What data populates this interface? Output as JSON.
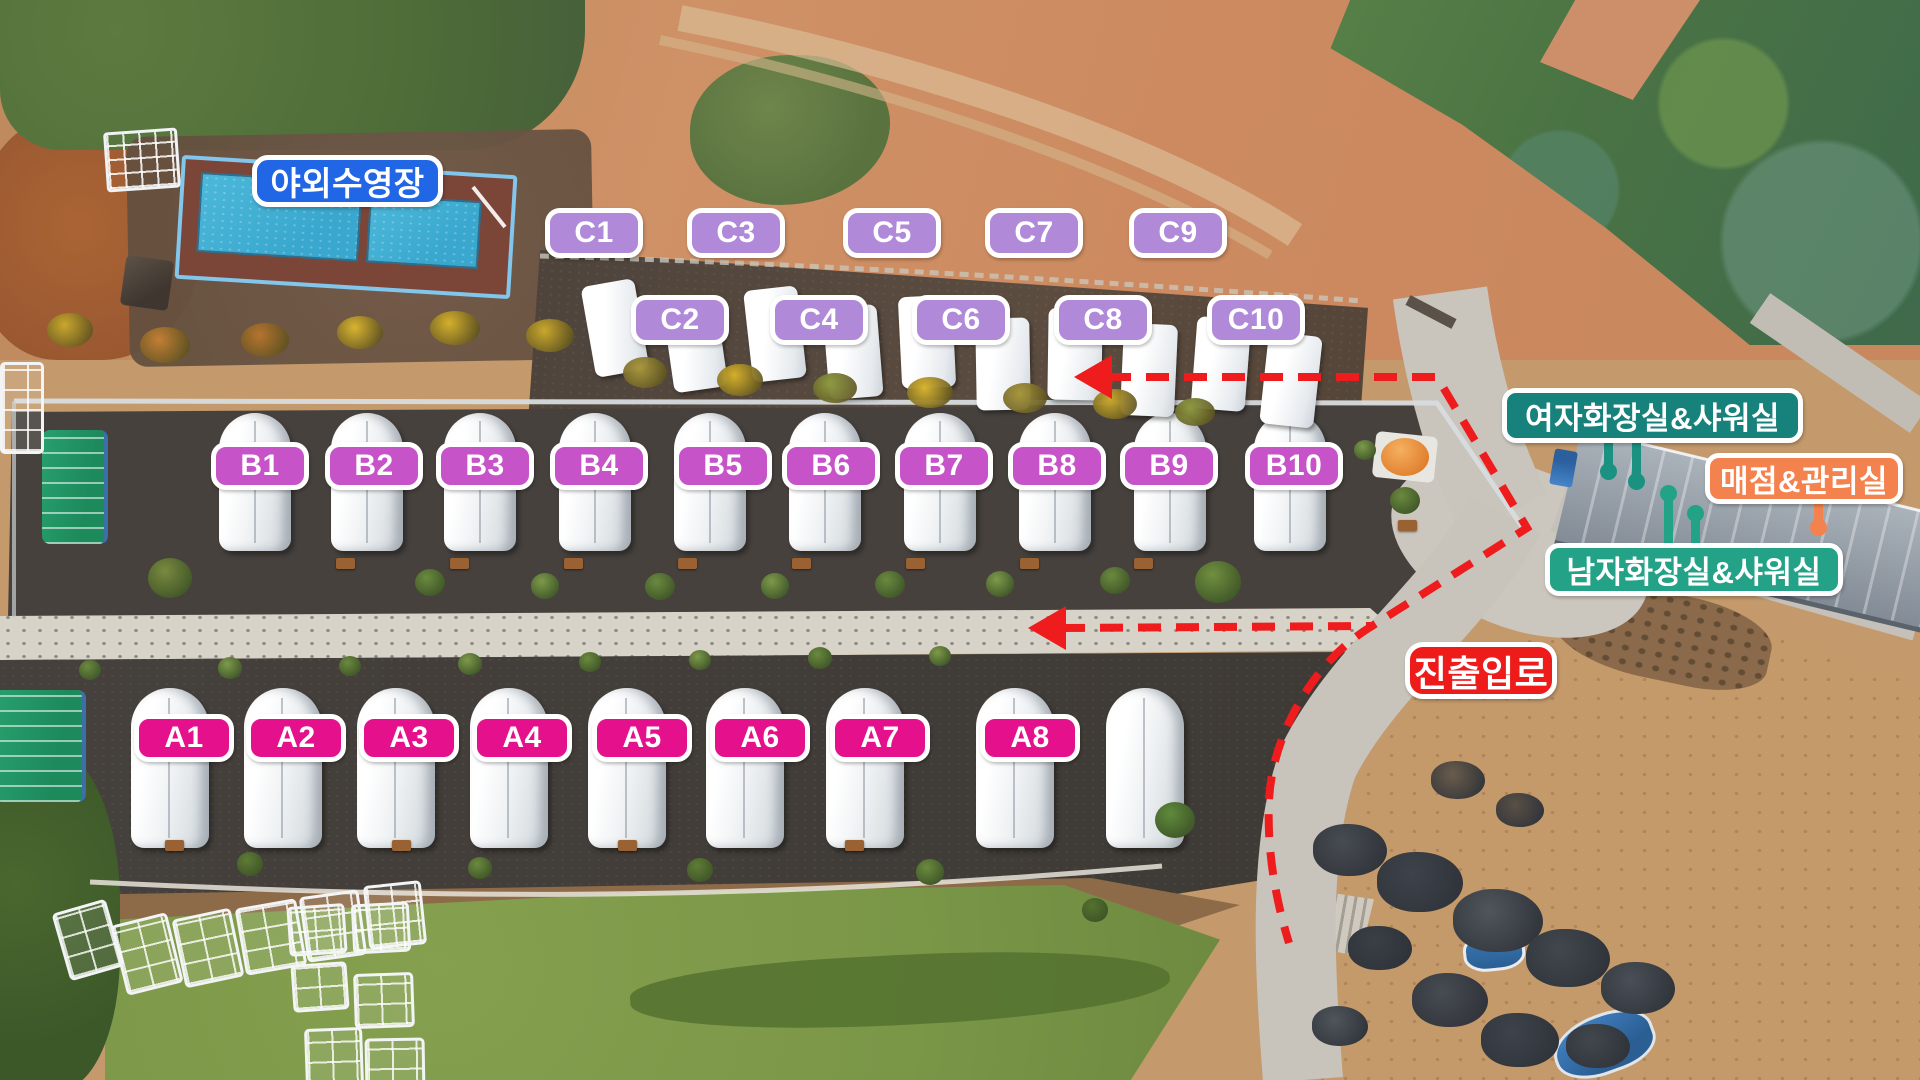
{
  "map": {
    "pool_label": "야외수영장",
    "pool_badge_color": "#2166e4",
    "route_color": "#ee1c1c",
    "rows": {
      "A": {
        "labels": [
          "A1",
          "A2",
          "A3",
          "A4",
          "A5",
          "A6",
          "A7",
          "A8"
        ],
        "color": "#e5108b"
      },
      "B": {
        "labels": [
          "B1",
          "B2",
          "B3",
          "B4",
          "B5",
          "B6",
          "B7",
          "B8",
          "B9",
          "B10"
        ],
        "color": "#c653c8"
      },
      "C": {
        "labels": [
          "C1",
          "C2",
          "C3",
          "C4",
          "C5",
          "C6",
          "C7",
          "C8",
          "C9",
          "C10"
        ],
        "color": "#b08ad8"
      }
    },
    "facilities": {
      "women_restroom": {
        "label": "여자화장실&샤워실",
        "color": "#17827b"
      },
      "store_office": {
        "label": "매점&관리실",
        "color": "#f4824e"
      },
      "men_restroom": {
        "label": "남자화장실&샤워실",
        "color": "#23a287"
      },
      "entrance_road": {
        "label": "진출입로",
        "color": "#ee1b1b"
      }
    }
  }
}
